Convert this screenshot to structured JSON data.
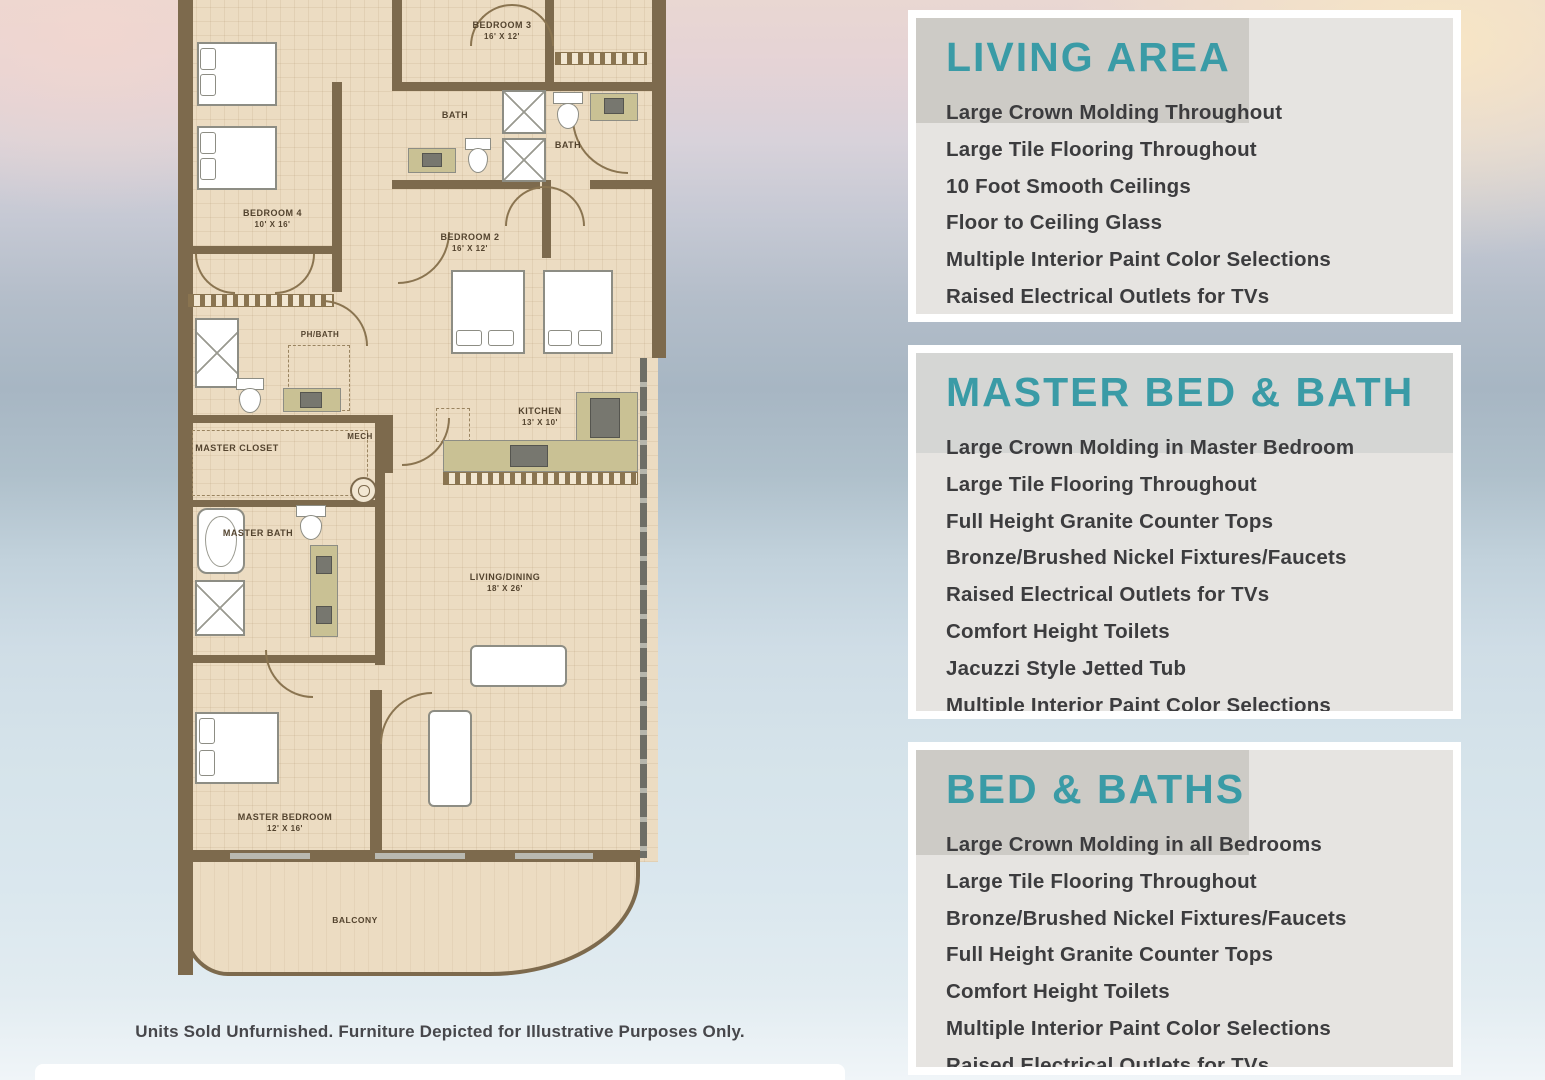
{
  "colors": {
    "accent_teal": "#3A9BA6",
    "panel_bg": "#E5E3E0",
    "wall_brown": "#7D6A4D",
    "floor_beige": "#ECDCC2",
    "counter_olive": "#C9C194",
    "list_text": "#3C3C3E"
  },
  "floor_plan": {
    "rooms": [
      {
        "label": "BEDROOM 3",
        "dims": "16' x 12'"
      },
      {
        "label": "BATH",
        "dims": ""
      },
      {
        "label": "BATH",
        "dims": ""
      },
      {
        "label": "BEDROOM 4",
        "dims": "10' x 16'"
      },
      {
        "label": "BEDROOM 2",
        "dims": "16' x 12'"
      },
      {
        "label": "PH/BATH",
        "dims": ""
      },
      {
        "label": "MECH",
        "dims": ""
      },
      {
        "label": "MASTER CLOSET",
        "dims": ""
      },
      {
        "label": "KITCHEN",
        "dims": "13' x 10'"
      },
      {
        "label": "MASTER BATH",
        "dims": ""
      },
      {
        "label": "LIVING/DINING",
        "dims": "18' x 26'"
      },
      {
        "label": "MASTER BEDROOM",
        "dims": "12' x 16'"
      },
      {
        "label": "BALCONY",
        "dims": ""
      }
    ],
    "disclaimer": "Units Sold Unfurnished. Furniture Depicted for Illustrative Purposes Only."
  },
  "panels": [
    {
      "title": "LIVING AREA",
      "items": [
        "Large Crown Molding Throughout",
        "Large Tile Flooring Throughout",
        "10 Foot Smooth Ceilings",
        "Floor to Ceiling Glass",
        "Multiple Interior Paint Color Selections",
        "Raised Electrical Outlets for TVs"
      ]
    },
    {
      "title": "MASTER BED & BATH",
      "items": [
        "Large Crown Molding in Master Bedroom",
        "Large Tile Flooring Throughout",
        "Full Height Granite Counter Tops",
        "Bronze/Brushed Nickel Fixtures/Faucets",
        "Raised Electrical Outlets for TVs",
        "Comfort Height Toilets",
        "Jacuzzi Style Jetted Tub",
        "Multiple Interior Paint Color Selections"
      ]
    },
    {
      "title": "BED & BATHS",
      "items": [
        "Large Crown Molding in all Bedrooms",
        "Large Tile Flooring Throughout",
        "Bronze/Brushed Nickel Fixtures/Faucets",
        "Full Height Granite Counter Tops",
        "Comfort Height Toilets",
        "Multiple Interior Paint Color Selections",
        "Raised Electrical Outlets for TVs"
      ]
    }
  ]
}
